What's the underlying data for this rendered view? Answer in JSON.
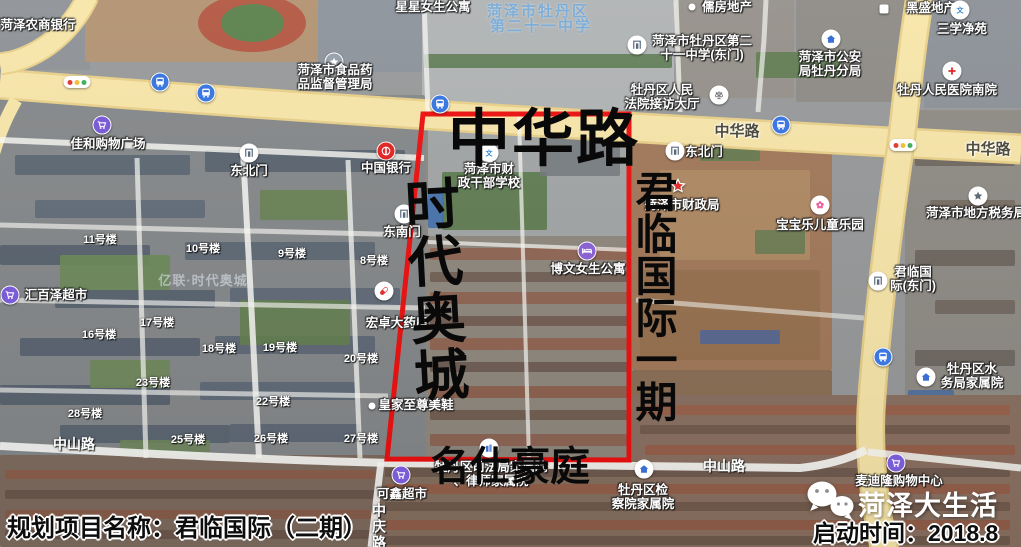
{
  "annotations": {
    "road_top": "中华路",
    "left_area": "时代奥城",
    "right_area": "君临国际一期",
    "bottom_area": "名仕豪庭"
  },
  "caption": {
    "project_label": "规划项目名称：君临国际（二期）",
    "start_label": "启动时间：2018.8",
    "brand": "菏泽大生活"
  },
  "boundary": {
    "points": "423,114 629,114 629,460 387,459",
    "color": "#ee0f0f"
  },
  "colors": {
    "road_fill": "#f8e6a9",
    "road_edge": "#e9d089",
    "minor_road": "#fcfcf8"
  },
  "road_labels": [
    {
      "text": "中华路",
      "x": 737,
      "y": 120,
      "style": "major",
      "vertical": false
    },
    {
      "text": "中华路",
      "x": 988,
      "y": 138,
      "style": "major",
      "vertical": false
    },
    {
      "text": "中山路",
      "x": 74,
      "y": 434,
      "style": "minor",
      "vertical": false
    },
    {
      "text": "中山路",
      "x": 724,
      "y": 456,
      "style": "minor",
      "vertical": false
    },
    {
      "text": "中庆路",
      "x": 379,
      "y": 503,
      "style": "minor",
      "vertical": true
    }
  ],
  "watermarks": [
    {
      "text": "菏泽市牡丹区",
      "x": 538,
      "y": 0,
      "style": "blue"
    },
    {
      "text": "第二十一中学",
      "x": 541,
      "y": 15,
      "style": "blue"
    },
    {
      "text": "亿联·时代奥城",
      "x": 203,
      "y": 270,
      "style": "faint"
    }
  ],
  "building_labels": [
    {
      "text": "11号楼",
      "x": 100,
      "y": 231
    },
    {
      "text": "10号楼",
      "x": 203,
      "y": 240
    },
    {
      "text": "9号楼",
      "x": 292,
      "y": 245
    },
    {
      "text": "8号楼",
      "x": 374,
      "y": 252
    },
    {
      "text": "16号楼",
      "x": 99,
      "y": 326
    },
    {
      "text": "17号楼",
      "x": 157,
      "y": 314
    },
    {
      "text": "18号楼",
      "x": 219,
      "y": 340
    },
    {
      "text": "19号楼",
      "x": 280,
      "y": 339
    },
    {
      "text": "20号楼",
      "x": 361,
      "y": 350
    },
    {
      "text": "23号楼",
      "x": 153,
      "y": 374
    },
    {
      "text": "22号楼",
      "x": 273,
      "y": 393
    },
    {
      "text": "28号楼",
      "x": 85,
      "y": 405
    },
    {
      "text": "25号楼",
      "x": 188,
      "y": 431
    },
    {
      "text": "26号楼",
      "x": 271,
      "y": 430
    },
    {
      "text": "27号楼",
      "x": 361,
      "y": 430
    }
  ],
  "map_icons": [
    {
      "type": "traffic",
      "x": 77,
      "y": 82
    },
    {
      "type": "traffic",
      "x": 903,
      "y": 145
    },
    {
      "type": "bus",
      "x": 160,
      "y": 82
    },
    {
      "type": "bus",
      "x": 206,
      "y": 93
    },
    {
      "type": "bus",
      "x": 440,
      "y": 104
    },
    {
      "type": "bus",
      "x": 781,
      "y": 125
    },
    {
      "type": "bus",
      "x": 883,
      "y": 357
    }
  ],
  "pois": [
    {
      "id": "heze-rural-commercial-bank",
      "icon": "",
      "ix": 0,
      "iy": 0,
      "tx": 38,
      "ty": 19,
      "lines": [
        "菏泽农商银行"
      ]
    },
    {
      "id": "xingxing-girls-apartment",
      "icon": "",
      "ix": 0,
      "iy": 0,
      "tx": 433,
      "ty": 1,
      "lines": [
        "星星女生公寓"
      ]
    },
    {
      "id": "rufang-realty",
      "icon": "dot",
      "ix": 692,
      "iy": 7,
      "tx": 727,
      "ty": 1,
      "lines": [
        "儒房地产"
      ]
    },
    {
      "id": "heisheng-realty",
      "icon": "square",
      "ix": 884,
      "iy": 9,
      "tx": 931,
      "ty": 2,
      "lines": [
        "黑盛地产"
      ]
    },
    {
      "id": "food-drug-administration",
      "icon": "star_gray",
      "ix": 334,
      "iy": 62,
      "tx": 335,
      "ty": 64,
      "lines": [
        "菏泽市食品药",
        "品监督管理局"
      ]
    },
    {
      "id": "no21-middle-school-east-gate",
      "icon": "gate",
      "ix": 637,
      "iy": 45,
      "tx": 702,
      "ty": 35,
      "lines": [
        "菏泽市牡丹区第二",
        "十一中学(东门)"
      ]
    },
    {
      "id": "public-security-mudan-branch",
      "icon": "house",
      "ix": 831,
      "iy": 39,
      "tx": 830,
      "ty": 51,
      "lines": [
        "菏泽市公安",
        "局牡丹分局"
      ]
    },
    {
      "id": "sanxue-jingyuan",
      "icon": "wen",
      "ix": 960,
      "iy": 10,
      "tx": 962,
      "ty": 23,
      "lines": [
        "三学净苑"
      ]
    },
    {
      "id": "mudan-people-hospital-south",
      "icon": "cross",
      "ix": 952,
      "iy": 71,
      "tx": 947,
      "ty": 84,
      "lines": [
        "牡丹人民医院南院"
      ]
    },
    {
      "id": "mudan-court-reception-hall",
      "icon": "scales",
      "ix": 719,
      "iy": 95,
      "tx": 662,
      "ty": 84,
      "lines": [
        "牡丹区人民",
        "法院接访大厅"
      ]
    },
    {
      "id": "jiahe-shopping-plaza",
      "icon": "cart",
      "ix": 102,
      "iy": 125,
      "tx": 108,
      "ty": 138,
      "lines": [
        "佳和购物广场"
      ]
    },
    {
      "id": "northeast-gate-west",
      "icon": "gate",
      "ix": 249,
      "iy": 153,
      "tx": 249,
      "ty": 165,
      "lines": [
        "东北门"
      ]
    },
    {
      "id": "bank-of-china",
      "icon": "boc",
      "ix": 386,
      "iy": 151,
      "tx": 386,
      "ty": 162,
      "lines": [
        "中国银行"
      ]
    },
    {
      "id": "southeast-gate",
      "icon": "gate",
      "ix": 404,
      "iy": 214,
      "tx": 402,
      "ty": 226,
      "lines": [
        "东南门"
      ]
    },
    {
      "id": "finance-cadre-school",
      "icon": "wen",
      "ix": 489,
      "iy": 153,
      "tx": 489,
      "ty": 163,
      "lines": [
        "菏泽市财",
        "政干部学校"
      ]
    },
    {
      "id": "northeast-gate-east",
      "icon": "gate",
      "ix": 675,
      "iy": 151,
      "tx": 704,
      "ty": 146,
      "lines": [
        "东北门"
      ]
    },
    {
      "id": "heze-finance-bureau",
      "icon": "star_red",
      "ix": 678,
      "iy": 186,
      "tx": 682,
      "ty": 199,
      "lines": [
        "菏泽市财政局"
      ]
    },
    {
      "id": "local-tax-bureau",
      "icon": "star_white",
      "ix": 978,
      "iy": 196,
      "tx": 976,
      "ty": 207,
      "lines": [
        "菏泽市地方税务局"
      ]
    },
    {
      "id": "baobaole-children-playground",
      "icon": "flower",
      "ix": 820,
      "iy": 205,
      "tx": 820,
      "ty": 219,
      "lines": [
        "宝宝乐儿童乐园"
      ]
    },
    {
      "id": "junlin-international-east-gate",
      "icon": "gate",
      "ix": 878,
      "iy": 281,
      "tx": 913,
      "ty": 266,
      "lines": [
        "君临国",
        "际(东门)"
      ]
    },
    {
      "id": "huibaize-supermarket",
      "icon": "cart",
      "ix": 10,
      "iy": 295,
      "tx": 56,
      "ty": 289,
      "lines": [
        "汇百泽超市"
      ]
    },
    {
      "id": "hongzhuo-pharmacy",
      "icon": "pill",
      "ix": 384,
      "iy": 291,
      "tx": 397,
      "ty": 317,
      "lines": [
        "宏卓大药房"
      ]
    },
    {
      "id": "bowen-girls-apartment",
      "icon": "bed",
      "ix": 587,
      "iy": 251,
      "tx": 588,
      "ty": 263,
      "lines": [
        "博文女生公寓"
      ]
    },
    {
      "id": "water-bureau-family-compound",
      "icon": "house",
      "ix": 926,
      "iy": 377,
      "tx": 972,
      "ty": 363,
      "lines": [
        "牡丹区水",
        "务局家属院"
      ]
    },
    {
      "id": "royal-supreme-shoes",
      "icon": "dot",
      "ix": 372,
      "iy": 406,
      "tx": 416,
      "ty": 399,
      "lines": [
        "皇家至尊美鞋"
      ]
    },
    {
      "id": "kexin-supermarket",
      "icon": "cart",
      "ix": 401,
      "iy": 475,
      "tx": 402,
      "ty": 488,
      "lines": [
        "可鑫超市"
      ]
    },
    {
      "id": "maidilong-shopping-center",
      "icon": "cart",
      "ix": 896,
      "iy": 463,
      "tx": 899,
      "ty": 475,
      "lines": [
        "麦迪隆购物中心"
      ]
    },
    {
      "id": "justice-bureau-lawyer-compound",
      "icon": "building",
      "ix": 489,
      "iy": 448,
      "tx": 491,
      "ty": 461,
      "lines": [
        "牡丹区司法局家属院",
        "、律师家属院"
      ]
    },
    {
      "id": "procuratorate-family-compound",
      "icon": "house",
      "ix": 644,
      "iy": 469,
      "tx": 643,
      "ty": 484,
      "lines": [
        "牡丹区检",
        "察院家属院"
      ]
    }
  ]
}
